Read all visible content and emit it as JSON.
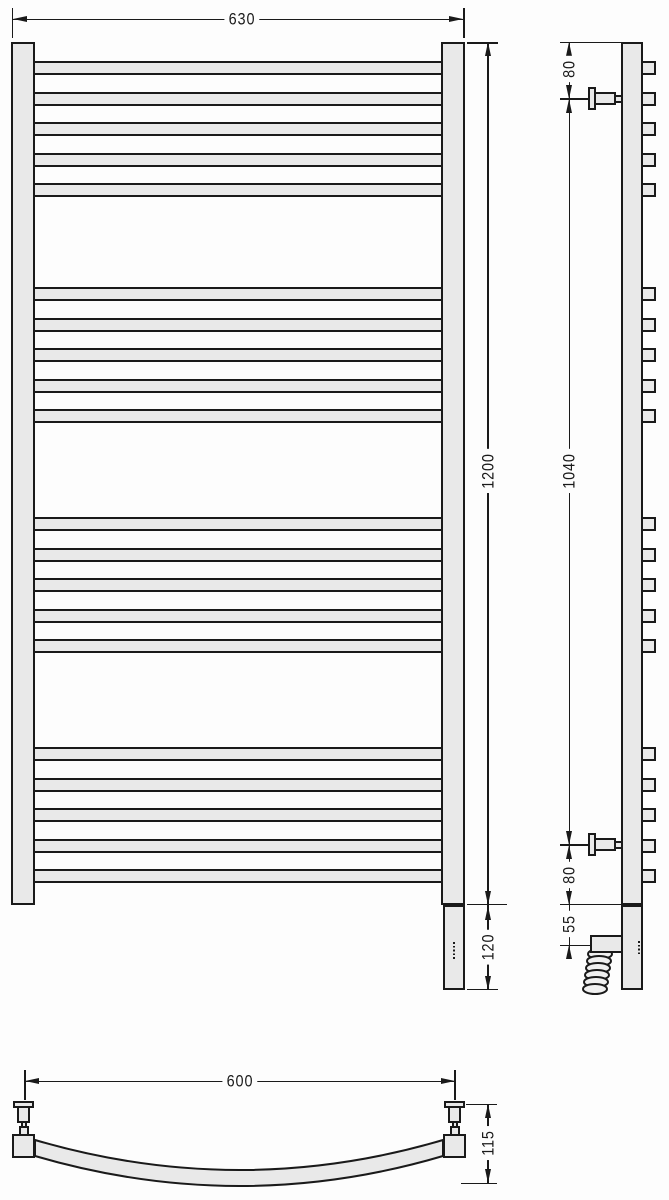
{
  "drawing": {
    "description": "Technical dimension drawing of a curved ladder heated towel rail: front view, side view and plan view",
    "colors": {
      "line": "#1a1a1a",
      "fill": "#e9e9e9",
      "background": "#fdfdfd"
    },
    "front_view": {
      "width_dim": "630",
      "height_dim": "1200",
      "bottom_section_dim": "120",
      "rung_groups": 4,
      "rungs_per_group": 5,
      "rungs_total": 20
    },
    "side_view": {
      "top_connector_offset_dim": "80",
      "connectors_span_dim": "1040",
      "bottom_connector_offset_dim": "80",
      "heater_offset_dim": "55"
    },
    "plan_view": {
      "connectors_spacing_dim": "600",
      "depth_dim": "115"
    }
  }
}
